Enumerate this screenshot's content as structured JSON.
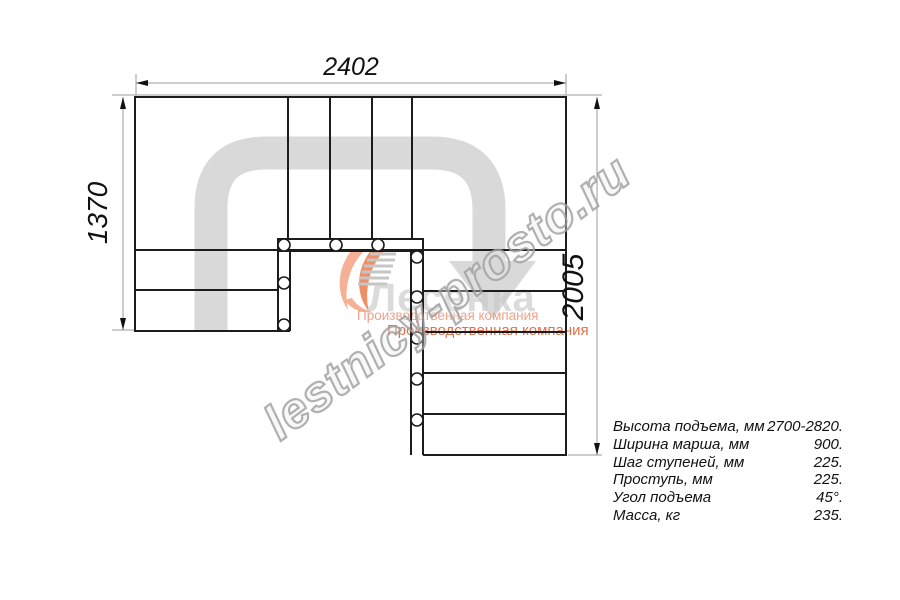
{
  "drawing": {
    "title": "Stair plan view (U-shaped staircase)",
    "dim_width_top": "2402",
    "dim_height_left": "1370",
    "dim_height_right": "2005"
  },
  "logo": {
    "name": "Лесенка",
    "tagline1": "Производственная компания",
    "tagline2": "Производственная компания"
  },
  "watermark": {
    "text": "lestnicy-prosto.ru"
  },
  "specs": {
    "rows": [
      {
        "label": "Высота подъема, мм",
        "value": "2700-2820."
      },
      {
        "label": "Ширина марша, мм",
        "value": "900."
      },
      {
        "label": "Шаг ступеней, мм",
        "value": "225."
      },
      {
        "label": "Проступь, мм",
        "value": "225."
      },
      {
        "label": "Угол подъема",
        "value": "45°."
      },
      {
        "label": "Масса, кг",
        "value": "235."
      }
    ]
  },
  "colors": {
    "line": "#1c1c1c",
    "dimension_line": "#9b9b9b",
    "direction_arrow": "#d9d9d9",
    "watermark_outline": "#9e9e9e",
    "logo_flame_light": "#f6b096",
    "logo_flame_dark": "#ef8f68",
    "logo_tagline1": "#efa18a",
    "logo_tagline2": "#e0704a"
  }
}
